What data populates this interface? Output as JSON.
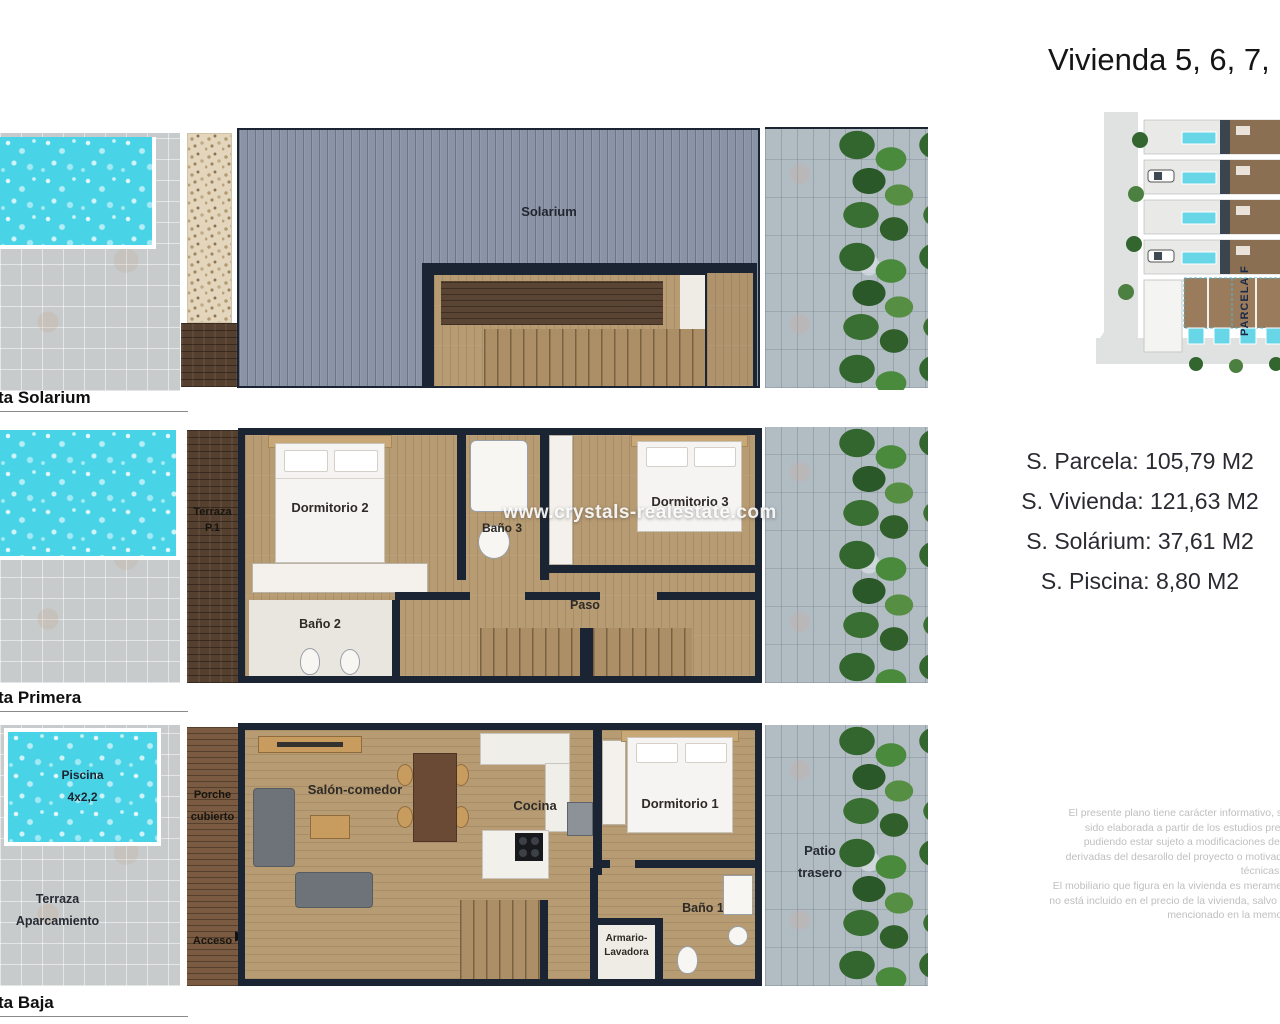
{
  "header": {
    "title": "Vivienda 5, 6, 7,"
  },
  "site_plan": {
    "parcela_label": "PARCELA F"
  },
  "specs": {
    "parcela": "S. Parcela: 105,79 M2",
    "vivienda": "S. Vivienda: 121,63 M2",
    "solarium": "S. Solárium: 37,61 M2",
    "piscina": "S. Piscina: 8,80 M2"
  },
  "watermark": "www.crystals-realestate.com",
  "plans": {
    "solarium": {
      "caption": "ta Solarium",
      "rooms": {
        "solarium": "Solarium"
      }
    },
    "primera": {
      "caption": "ta Primera",
      "rooms": {
        "terraza_line1": "Terraza",
        "terraza_line2": "P.1",
        "dormitorio2": "Dormitorio 2",
        "bano3": "Baño 3",
        "dormitorio3": "Dormitorio 3",
        "bano2": "Baño 2",
        "paso": "Paso"
      }
    },
    "baja": {
      "caption": "ta Baja",
      "rooms": {
        "piscina_line1": "Piscina",
        "piscina_line2": "4x2,2",
        "terraza_line1": "Terraza",
        "terraza_line2": "Aparcamiento",
        "porche_line1": "Porche",
        "porche_line2": "cubierto",
        "acceso": "Acceso",
        "acceso_arrow": "▶",
        "salon": "Salón-comedor",
        "cocina": "Cocina",
        "dormitorio1": "Dormitorio 1",
        "bano1": "Baño 1",
        "armario_line1": "Armario-",
        "armario_line2": "Lavadora",
        "patio_line1": "Patio",
        "patio_line2": "trasero"
      }
    }
  },
  "disclaimer": {
    "lines": [
      "El presente plano tiene carácter informativo, su",
      "sido elaborada a partir de los estudios previ",
      "pudiendo estar sujeto a modificaciones de c",
      "derivadas del desarollo del proyecto o motivada",
      "técnicas d",
      "El mobiliario que figura en la vivienda es meramen",
      "no está incluido en el precio de la vivienda, salvo lo",
      "mencionado en la memori"
    ]
  },
  "colors": {
    "pool": "#48d3e6",
    "wall": "#1b2433",
    "wood": "#b79b73",
    "deck": "#8b94a7",
    "tree": "#3a6f33"
  }
}
